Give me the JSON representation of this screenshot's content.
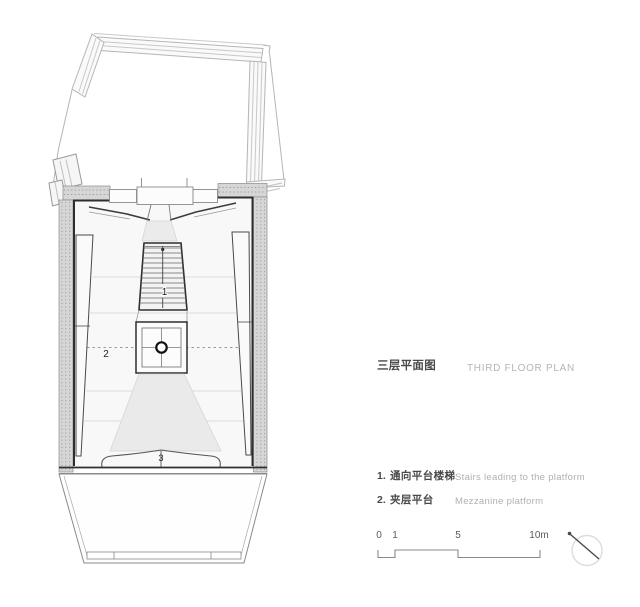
{
  "title": {
    "zh": "三层平面图",
    "en": "THIRD FLOOR PLAN"
  },
  "legend": {
    "items": [
      {
        "num": "1.",
        "zh": "通向平台楼梯",
        "en": "Stairs leading to the platform"
      },
      {
        "num": "2.",
        "zh": "夹层平台",
        "en": "Mezzanine platform"
      }
    ]
  },
  "plan_labels": {
    "stair": "1",
    "mezzanine": "2",
    "marker": "3"
  },
  "scale_bar": {
    "tick_labels": [
      "0",
      "1",
      "5",
      "10m"
    ]
  },
  "colors": {
    "wall_fill": "#d6d6d6",
    "wall_outline": "#2e2e2e",
    "shading": "#eaeaea",
    "light_line": "#b5b5b5",
    "text_dark": "#4a4a4a",
    "text_light": "#b5b5b5"
  }
}
